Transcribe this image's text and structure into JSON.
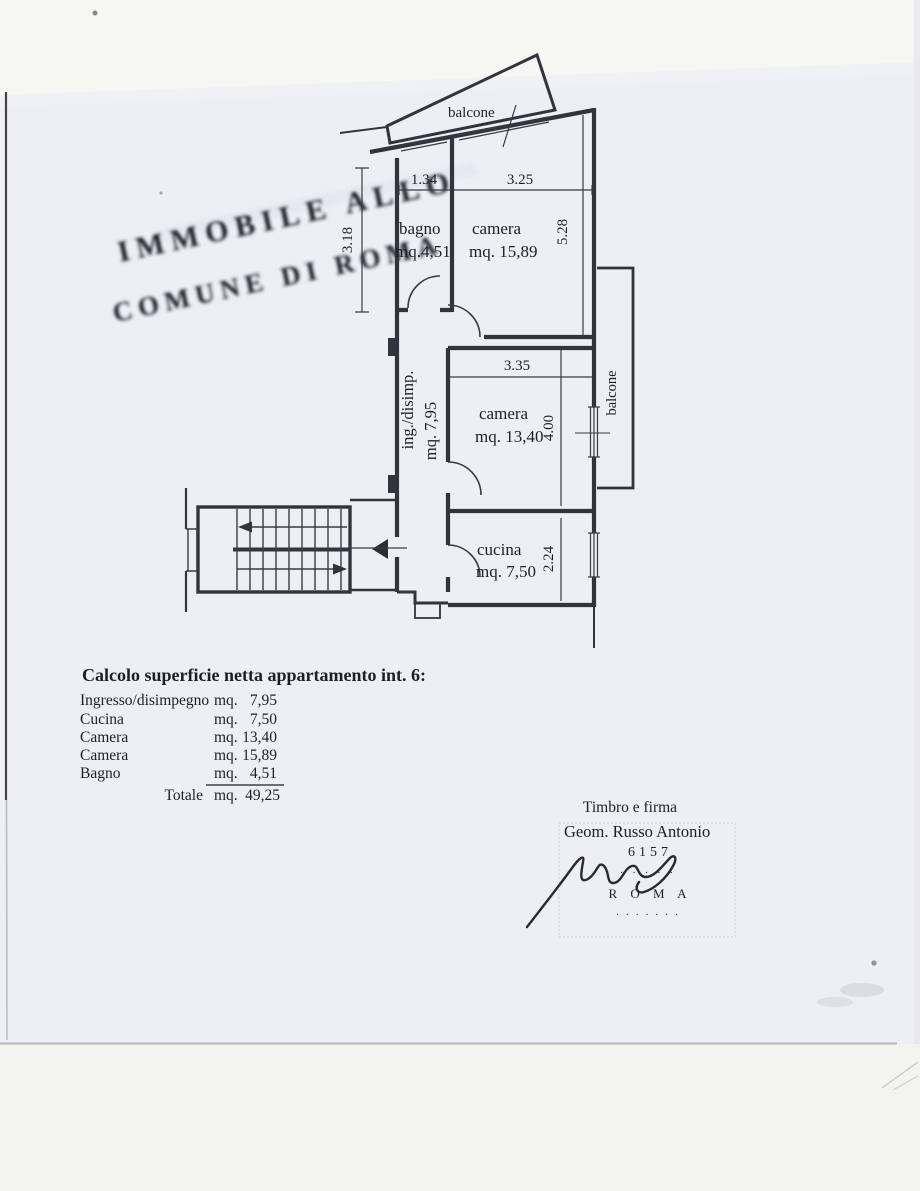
{
  "plan": {
    "balcony_top_label": "balcone",
    "balcony_right_label": "balcone",
    "rooms": {
      "bagno": {
        "name": "bagno",
        "area": "mq.4,51"
      },
      "camera1": {
        "name": "camera",
        "area": "mq. 15,89"
      },
      "camera2": {
        "name": "camera",
        "area": "mq. 13,40"
      },
      "cucina": {
        "name": "cucina",
        "area": "mq. 7,50"
      },
      "ingresso": {
        "name": "ing./disimp.",
        "area": "mq. 7,95"
      }
    },
    "dims": {
      "bagno_width": "1.34",
      "camera1_width": "3.25",
      "bagno_height": "3.18",
      "camera1_height": "5.28",
      "camera2_width": "3.35",
      "camera2_height": "4.00",
      "cucina_height": "2.24"
    }
  },
  "calc": {
    "title": "Calcolo superficie netta appartamento int. 6:",
    "rows": [
      {
        "label": "Ingresso/disimpegno",
        "unit": "mq.",
        "value": "7,95"
      },
      {
        "label": "Cucina",
        "unit": "mq.",
        "value": "7,50"
      },
      {
        "label": "Camera",
        "unit": "mq.",
        "value": "13,40"
      },
      {
        "label": "Camera",
        "unit": "mq.",
        "value": "15,89"
      },
      {
        "label": "Bagno",
        "unit": "mq.",
        "value": "4,51"
      }
    ],
    "total_label": "Totale",
    "total_unit": "mq.",
    "total_value": "49,25"
  },
  "signature": {
    "caption": "Timbro e firma",
    "name": "Geom. Russo Antonio"
  },
  "stamp": {
    "line1": "6157",
    "line2": "· · · · ·",
    "line3": "R O M A",
    "line4": "· · · · · · ·"
  },
  "watermark": {
    "line1": "IMMOBILE ALLO",
    "line2": "COMUNE DI ROMA"
  },
  "colors": {
    "paper": "#edeff5",
    "ink": "#33333d",
    "scan_band_top": "#f6f6f3",
    "scan_band_bottom": "#f3f3f0"
  }
}
